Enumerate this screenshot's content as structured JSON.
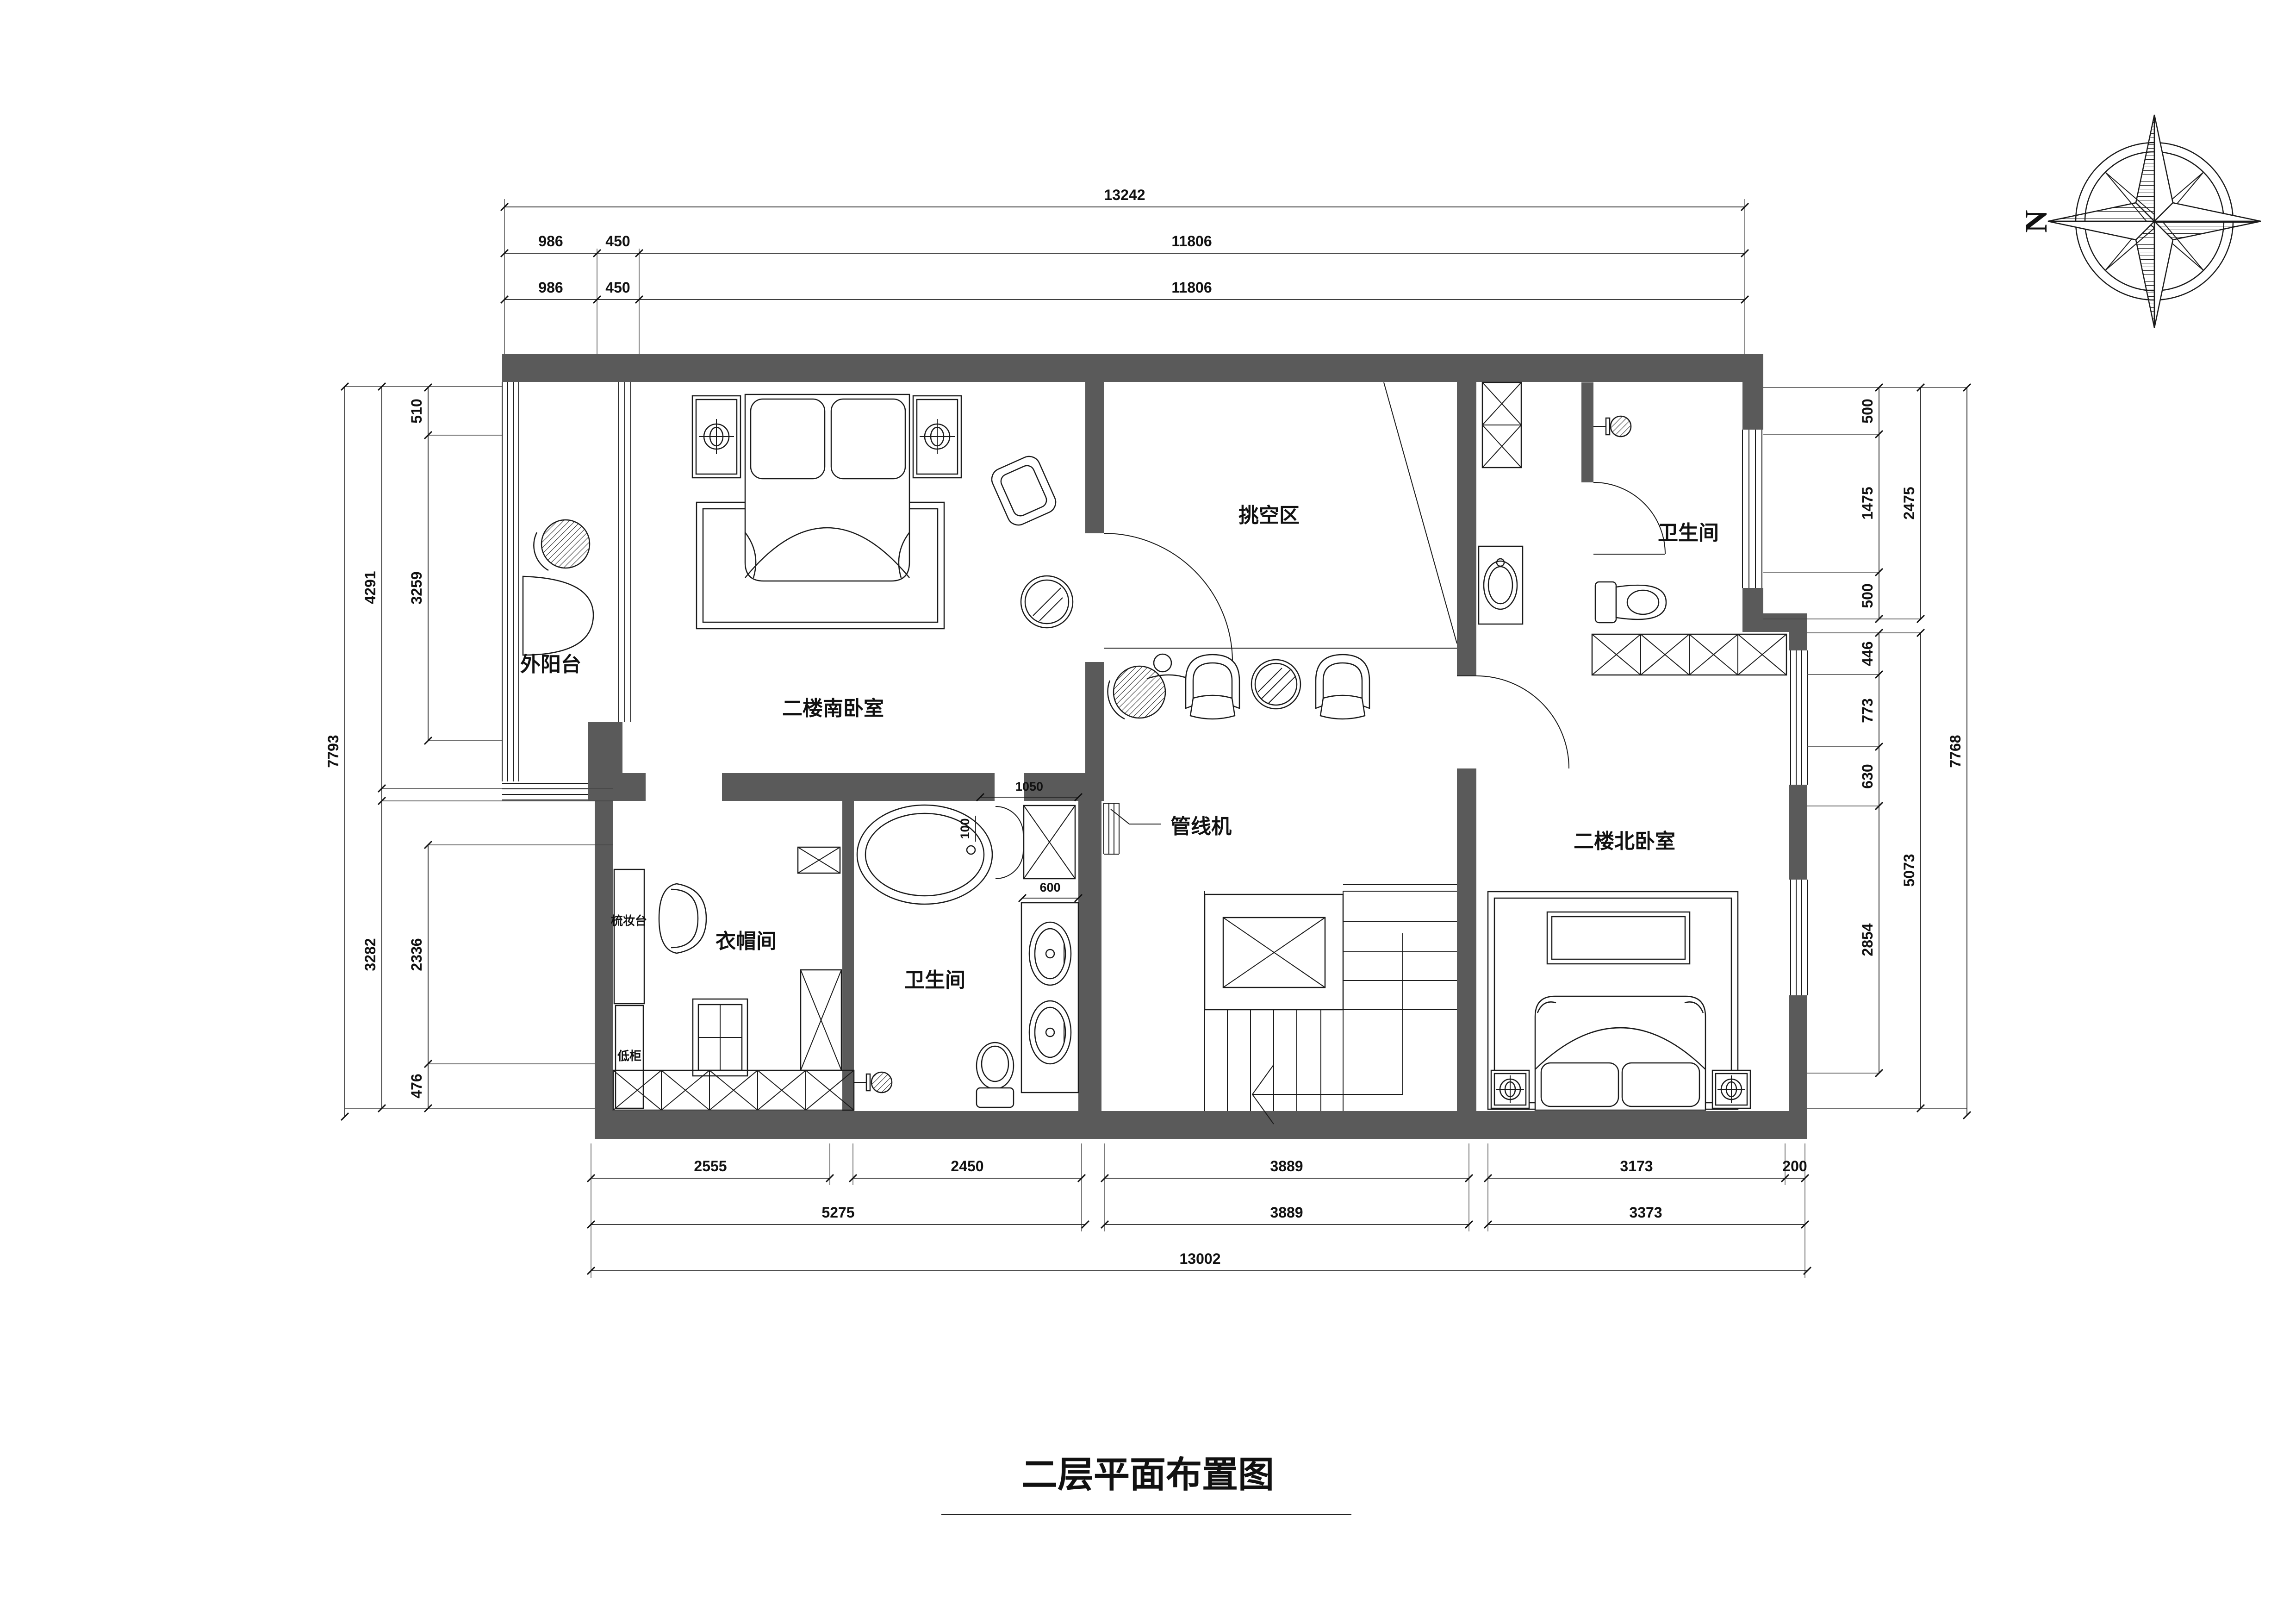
{
  "title": "二层平面布置图",
  "compass": {
    "north_label": "N"
  },
  "colors": {
    "wall": "#5a5a5a",
    "line": "#1b1b1b",
    "background": "#ffffff"
  },
  "rooms": {
    "balcony": "外阳台",
    "south_bedroom": "二楼南卧室",
    "void_area": "挑空区",
    "bathroom_north": "卫生间",
    "bathroom_south": "卫生间",
    "cloakroom": "衣帽间",
    "north_bedroom": "二楼北卧室",
    "dressing_table": "梳妆台",
    "low_cabinet": "低柜"
  },
  "callouts": {
    "pipeline_unit": "管线机"
  },
  "dims": {
    "top": {
      "total": "13242",
      "row2": [
        "986",
        "450",
        "11806"
      ],
      "row3": [
        "986",
        "450",
        "11806"
      ]
    },
    "left": {
      "outer": "7793",
      "mid": [
        "4291",
        "3282"
      ],
      "inner": [
        "510",
        "3259",
        "2336",
        "476"
      ]
    },
    "right": {
      "inner": [
        "500",
        "1475",
        "500",
        "446",
        "773",
        "630",
        "2854"
      ],
      "mid": [
        "2475",
        "5073"
      ],
      "outer": "7768"
    },
    "bottom": {
      "row1": [
        "2555",
        "2450",
        "3889",
        "3173",
        "200"
      ],
      "row2": [
        "5275",
        "3889",
        "3373"
      ],
      "total": "13002"
    },
    "inline": {
      "shower": "1050",
      "vanity": "600",
      "tub": "100"
    }
  }
}
